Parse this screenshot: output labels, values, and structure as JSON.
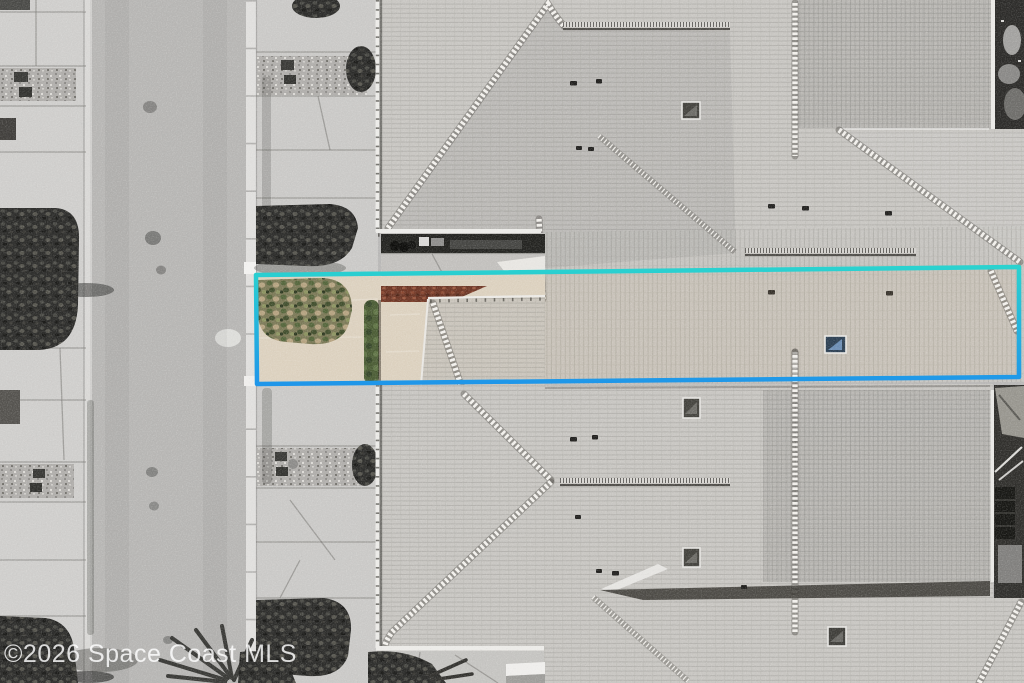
{
  "watermark": {
    "text": "©2026 Space Coast MLS"
  },
  "annotation": {
    "outline_top_color": "#2bd2cf",
    "outline_bottom_color": "#1f96e9",
    "outline_width": "4.5"
  },
  "scene": {
    "type": "aerial-top-down-photo",
    "highlight": "single townhouse lot outlined in cyan; interior of outline is in color, surroundings desaturated"
  }
}
